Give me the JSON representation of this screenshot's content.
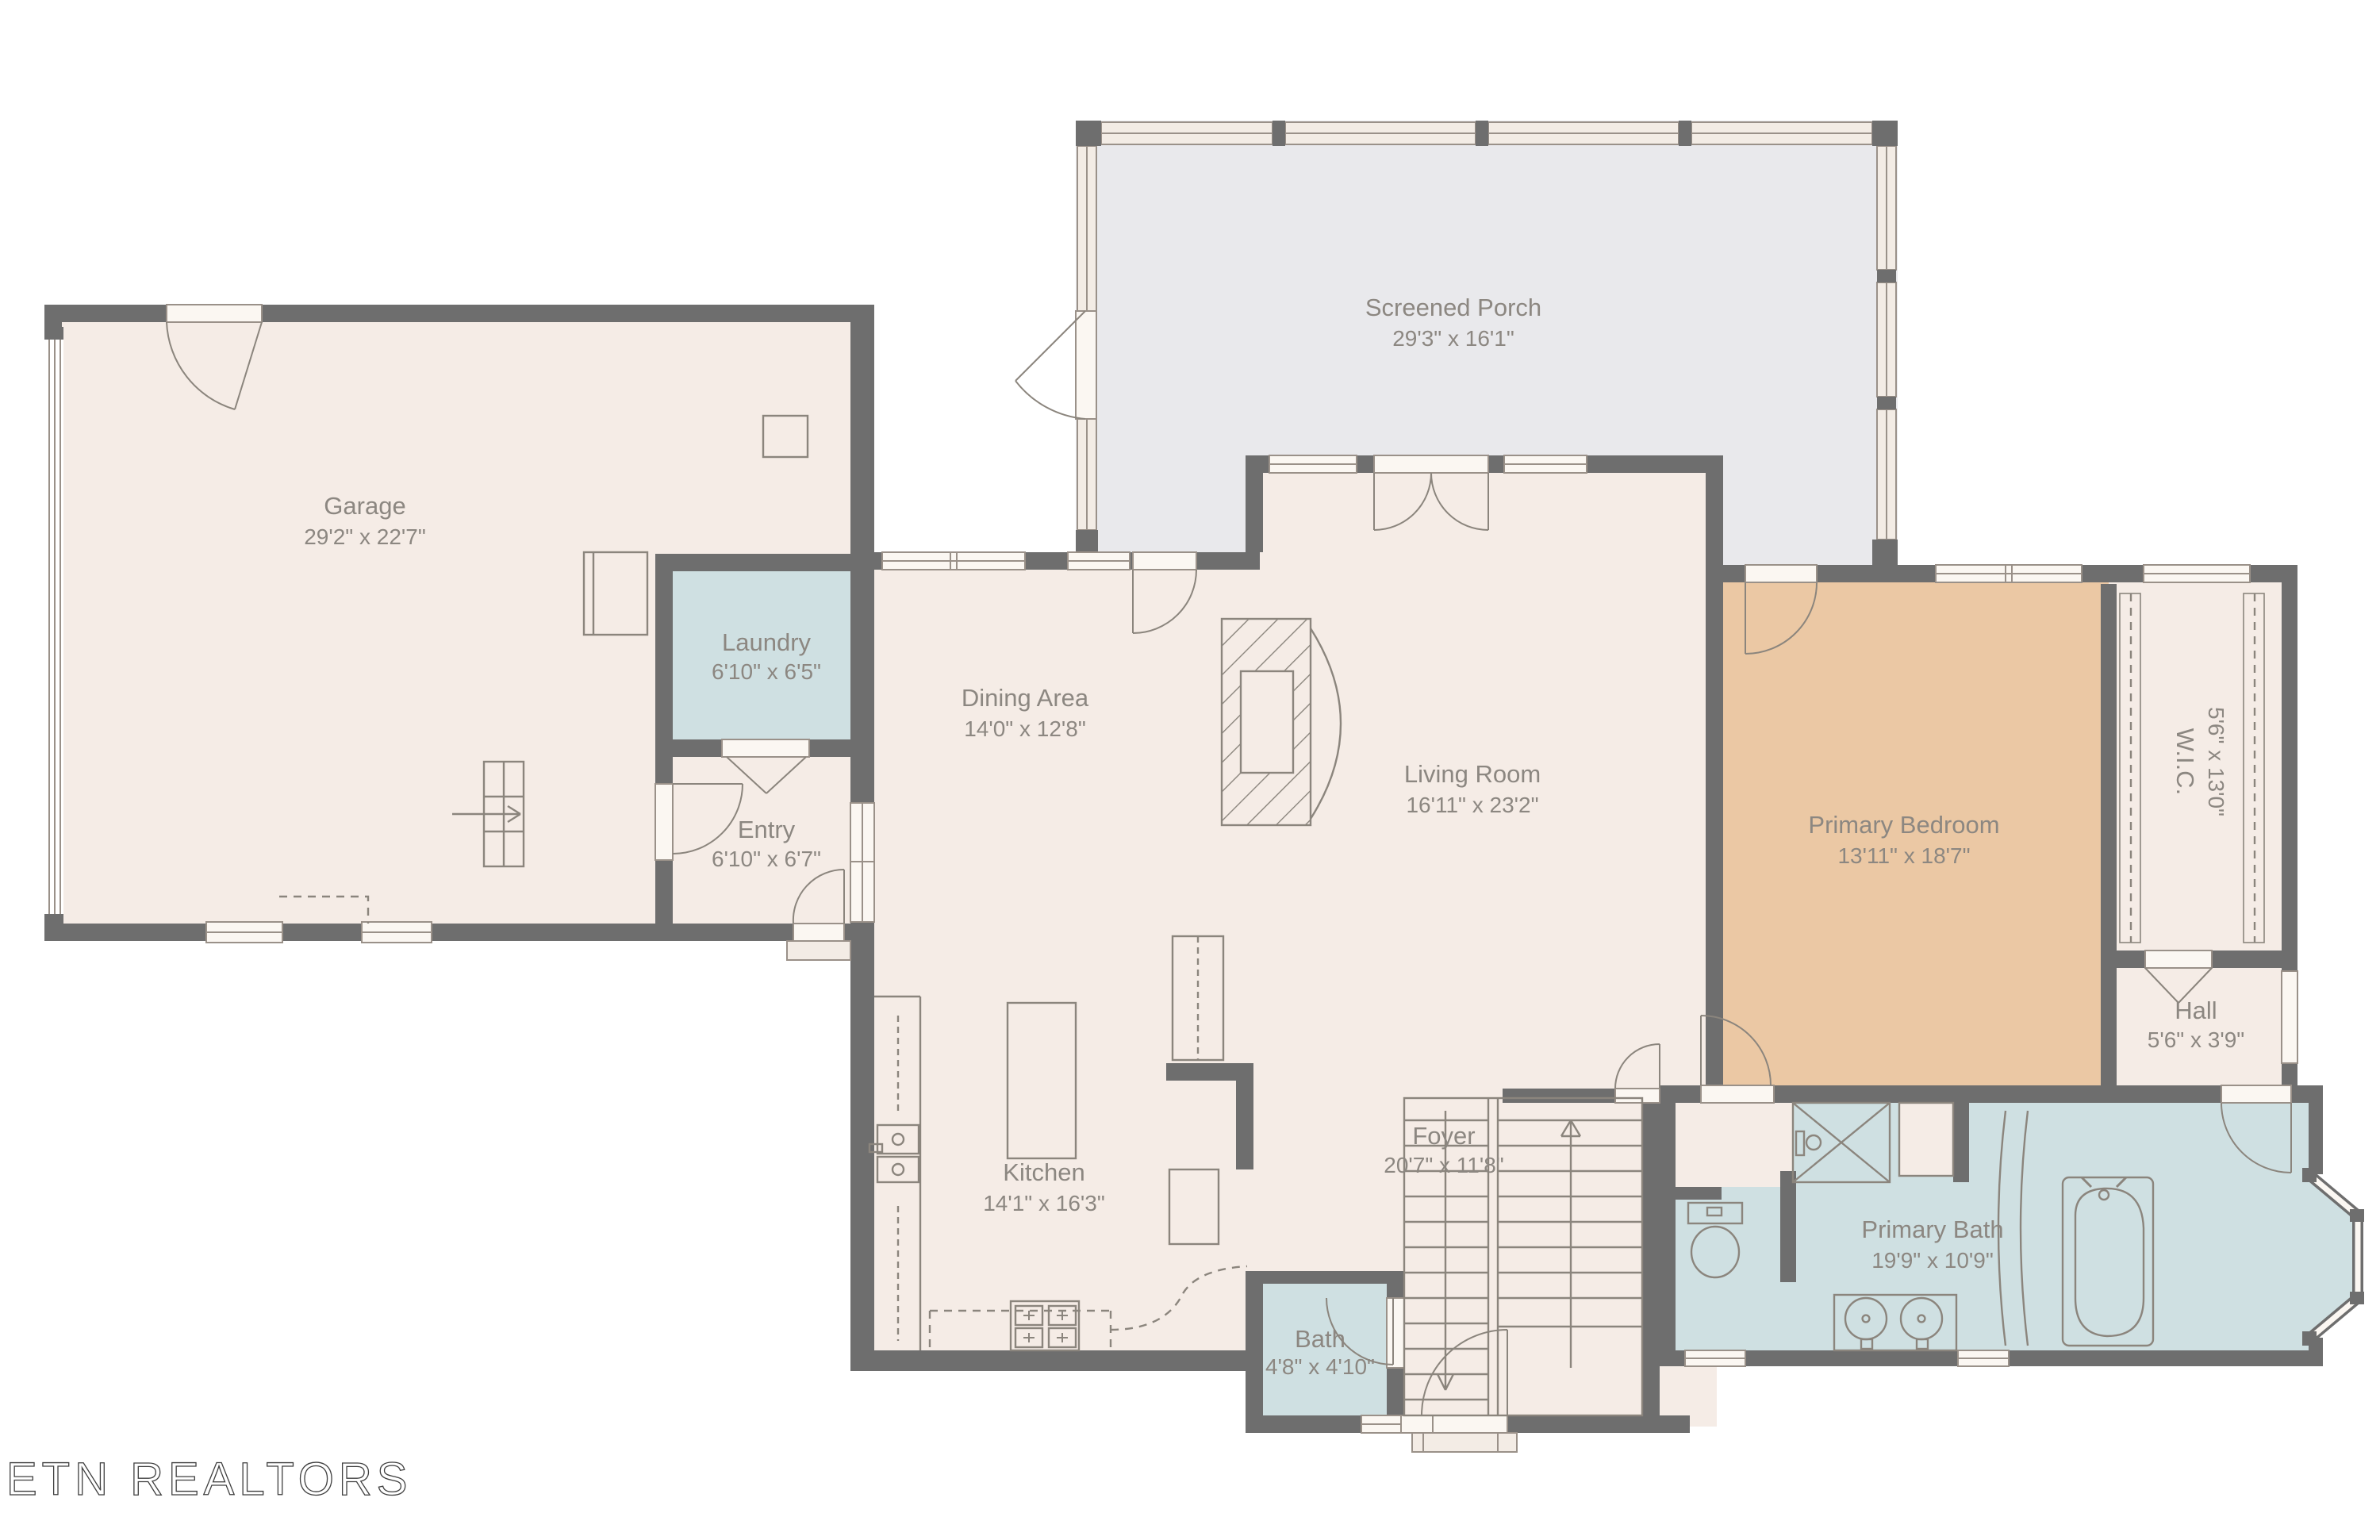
{
  "watermark": "ETN REALTORS",
  "palette": {
    "wall": "#6e6e6e",
    "cream": "#f5ece6",
    "porch_gray": "#e9e9ec",
    "wet_blue": "#cfe0e2",
    "bedroom_tan": "#ebc8a4",
    "label_text": "#8c8781",
    "fixture_line": "#8b857d"
  },
  "rooms": [
    {
      "id": "screened-porch",
      "name": "Screened Porch",
      "dims": "29'3\" x 16'1\"",
      "color": "#e9e9ec"
    },
    {
      "id": "garage",
      "name": "Garage",
      "dims": "29'2\" x 22'7\"",
      "color": "#f5ece6"
    },
    {
      "id": "laundry",
      "name": "Laundry",
      "dims": "6'10\" x 6'5\"",
      "color": "#cfe0e2"
    },
    {
      "id": "entry",
      "name": "Entry",
      "dims": "6'10\" x 6'7\"",
      "color": "#f5ece6"
    },
    {
      "id": "dining",
      "name": "Dining Area",
      "dims": "14'0\" x 12'8\"",
      "color": "#f5ece6"
    },
    {
      "id": "kitchen",
      "name": "Kitchen",
      "dims": "14'1\" x 16'3\"",
      "color": "#f5ece6"
    },
    {
      "id": "living",
      "name": "Living Room",
      "dims": "16'11\" x 23'2\"",
      "color": "#f5ece6"
    },
    {
      "id": "foyer",
      "name": "Foyer",
      "dims": "20'7\" x 11'8\"",
      "color": "#f5ece6"
    },
    {
      "id": "primary-bedroom",
      "name": "Primary Bedroom",
      "dims": "13'11\" x 18'7\"",
      "color": "#ebc8a4"
    },
    {
      "id": "wic",
      "name": "W.I.C.",
      "dims": "5'6\" x 13'0\"",
      "color": "#f5ece6"
    },
    {
      "id": "hall",
      "name": "Hall",
      "dims": "5'6\" x 3'9\"",
      "color": "#f5ece6"
    },
    {
      "id": "bath",
      "name": "Bath",
      "dims": "4'8\" x 4'10\"",
      "color": "#cfe0e2"
    },
    {
      "id": "primary-bath",
      "name": "Primary Bath",
      "dims": "19'9\" x 10'9\"",
      "color": "#cfe0e2"
    }
  ]
}
